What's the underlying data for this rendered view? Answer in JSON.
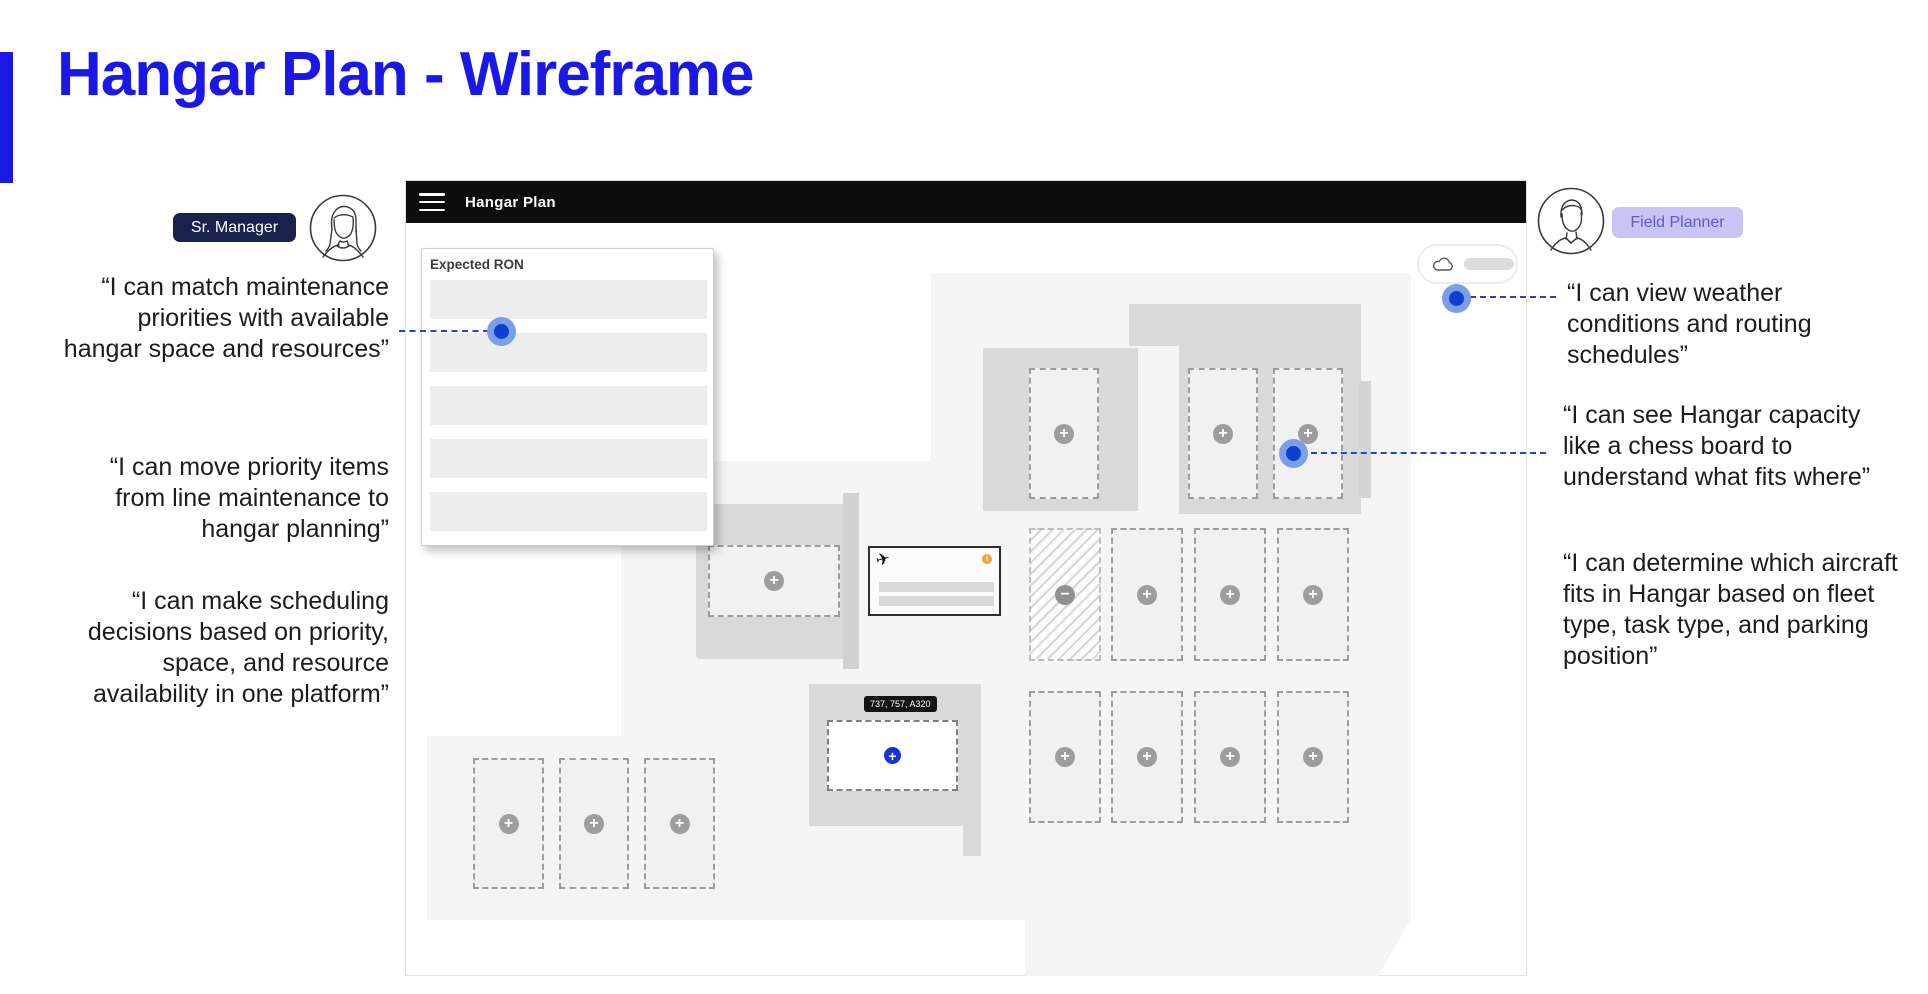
{
  "slide": {
    "title": "Hangar Plan - Wireframe",
    "accent_color": "#1a18e6"
  },
  "personas": {
    "left": {
      "label": "Sr. Manager",
      "badge_bg": "#19224d",
      "quotes": [
        "“I can match maintenance priorities with available hangar space and resources”",
        "“I can move priority items from line maintenance to hangar planning”",
        "“I can make scheduling decisions based on priority, space, and resource availability in one platform”"
      ]
    },
    "right": {
      "label": "Field Planner",
      "badge_bg": "#c8c5f5",
      "badge_text_color": "#5f58cf",
      "quotes": [
        "“I can view weather conditions and routing schedules”",
        "“I can see Hangar capacity like a chess board to understand what fits where”",
        "“I can determine which aircraft fits in Hangar based on fleet type, task type, and parking position”"
      ]
    }
  },
  "wireframe": {
    "header": {
      "title": "Hangar Plan"
    },
    "ron_panel": {
      "title": "Expected RON",
      "row_count": 5
    },
    "map": {
      "tooltip": "737, 757, A320"
    },
    "icons": {
      "add": "+",
      "remove": "−",
      "plane": "✈",
      "info": "i"
    }
  },
  "annotation": {
    "dot_color": "#0d3fd1",
    "dot_halo_color": "#7b9ee7",
    "connector_color": "#2743cb"
  }
}
